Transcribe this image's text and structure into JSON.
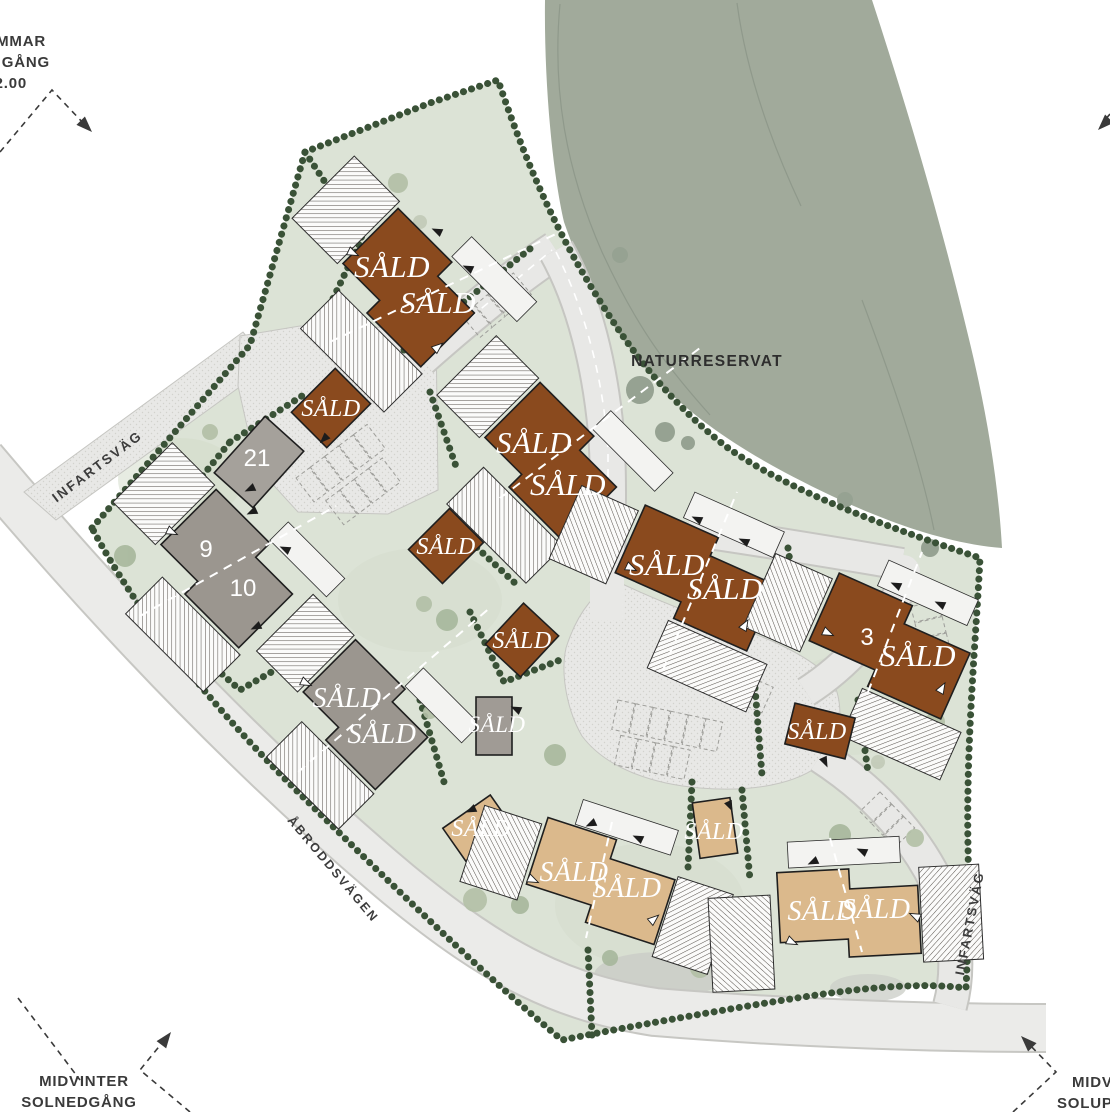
{
  "map": {
    "nature_reserve_label": "NATURRESERVAT",
    "road_labels": {
      "infartsvag_left": "INFARTSVÄG",
      "infartsvag_right": "INFARTSVÄG",
      "abroddsvagen": "ÅBRODDSVÄGEN"
    },
    "houses": [
      {
        "id": "house-1",
        "type": "duplex",
        "fill": "brown",
        "labels": [
          "SÅLD",
          "SÅLD"
        ]
      },
      {
        "id": "house-2",
        "type": "single",
        "fill": "brown",
        "labels": [
          "SÅLD"
        ]
      },
      {
        "id": "house-3",
        "type": "duplex",
        "fill": "brown",
        "labels": [
          "SÅLD",
          "SÅLD"
        ]
      },
      {
        "id": "house-4",
        "type": "single",
        "fill": "brown",
        "labels": [
          "SÅLD"
        ]
      },
      {
        "id": "house-5",
        "type": "single",
        "fill": "brown",
        "labels": [
          "SÅLD"
        ]
      },
      {
        "id": "house-6",
        "type": "duplex",
        "fill": "brown",
        "labels": [
          "SÅLD",
          "SÅLD"
        ]
      },
      {
        "id": "house-7",
        "type": "duplex",
        "fill": "brown",
        "plot_number": "3",
        "labels": [
          "SÅLD"
        ]
      },
      {
        "id": "house-8",
        "type": "single",
        "fill": "brown",
        "labels": [
          "SÅLD"
        ]
      },
      {
        "id": "house-9",
        "type": "single",
        "fill": "gray",
        "plot_number": "21",
        "labels": []
      },
      {
        "id": "house-10",
        "type": "duplex",
        "fill": "gray",
        "plot_numbers": [
          "9",
          "10"
        ],
        "labels": []
      },
      {
        "id": "house-11",
        "type": "duplex",
        "fill": "gray",
        "labels": [
          "SÅLD",
          "SÅLD"
        ]
      },
      {
        "id": "house-12",
        "type": "single",
        "fill": "gray",
        "labels": [
          "SÅLD"
        ]
      },
      {
        "id": "house-13",
        "type": "single",
        "fill": "tan",
        "labels": [
          "SÅLD"
        ]
      },
      {
        "id": "house-14",
        "type": "duplex",
        "fill": "tan",
        "labels": [
          "SÅLD",
          "SÅLD"
        ]
      },
      {
        "id": "house-15",
        "type": "single",
        "fill": "tan",
        "labels": [
          "SÅLD"
        ]
      },
      {
        "id": "house-16",
        "type": "duplex",
        "fill": "tan",
        "labels": [
          "SÅLD",
          "SÅLD"
        ]
      }
    ],
    "annotations": {
      "top_left": {
        "lines": [
          "MMAR",
          "GÅNG",
          "2.00"
        ]
      },
      "bottom_left": {
        "lines": [
          "MIDVINTER",
          "SOLNEDGÅNG"
        ]
      },
      "bottom_right": {
        "lines": [
          "MIDV",
          "SOLUPP"
        ]
      }
    }
  },
  "colors": {
    "sold_brown": "#8a4a1e",
    "sold_tan": "#dbb98c",
    "house_gray": "#9b968f",
    "site_green": "#dce3d6",
    "reserve_green": "#a1aa9b",
    "hedge_green": "#3a5237",
    "road_gray": "#e8e8e6",
    "label_white": "#ffffff",
    "annotation_gray": "#3a3a3a"
  }
}
